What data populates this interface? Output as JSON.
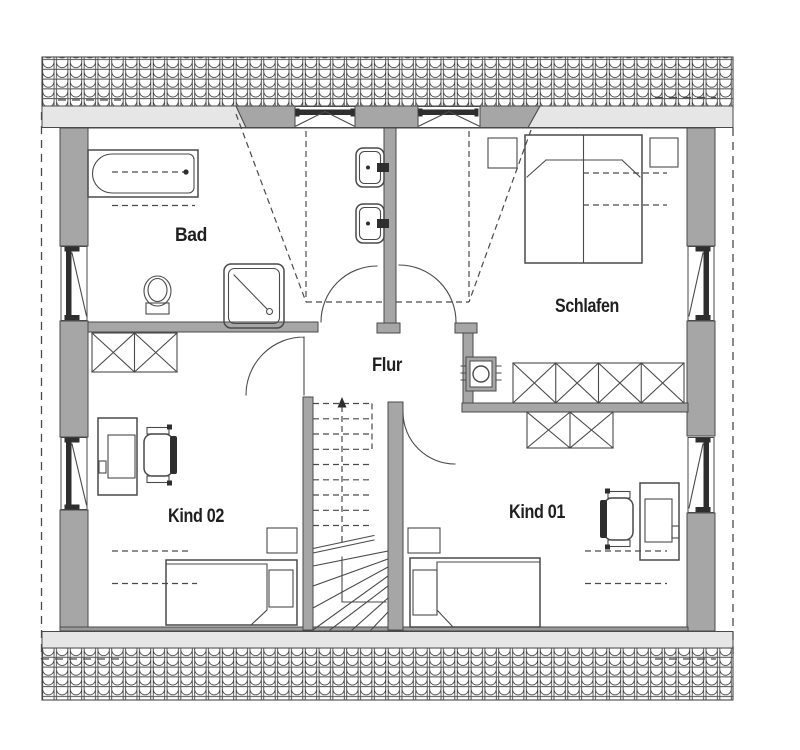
{
  "plan": {
    "type": "floor-plan",
    "floor_label": "",
    "rooms": [
      {
        "id": "bad",
        "label": "Bad",
        "furniture": [
          "bathtub",
          "toilet",
          "shower",
          "washbasin",
          "washbasin"
        ]
      },
      {
        "id": "schlafen",
        "label": "Schlafen",
        "furniture": [
          "double-bed",
          "nightstand",
          "nightstand",
          "wardrobe-4"
        ]
      },
      {
        "id": "flur",
        "label": "Flur",
        "furniture": [
          "chimney",
          "staircase"
        ]
      },
      {
        "id": "kind02",
        "label": "Kind 02",
        "furniture": [
          "wardrobe-2",
          "desk",
          "office-chair",
          "single-bed",
          "nightstand"
        ]
      },
      {
        "id": "kind01",
        "label": "Kind 01",
        "furniture": [
          "wardrobe-2",
          "desk",
          "office-chair",
          "single-bed",
          "nightstand"
        ]
      }
    ],
    "features": {
      "roof_bands": [
        "top-roof-tiles",
        "bottom-roof-tiles"
      ],
      "dormer_windows": 2,
      "gable_windows": 4,
      "doors": [
        "bad-door",
        "schlafen-door",
        "kind02-door",
        "kind01-door"
      ],
      "stairs": "winder-staircase"
    }
  },
  "colors": {
    "wall": "#a6a6a6",
    "eaves": "#e6e6e6",
    "line": "#4a4a4a",
    "dark": "#2e2e2e",
    "text": "#1f1f1f",
    "bg": "#ffffff",
    "tile": "#2e2e2e"
  }
}
